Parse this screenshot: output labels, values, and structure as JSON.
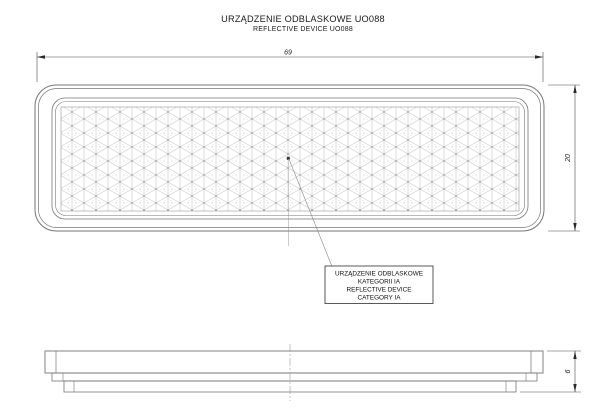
{
  "drawing": {
    "title": {
      "line1": "URZĄDZENIE ODBLASKOWE UO088",
      "line2": "REFLECTIVE DEVICE UO088"
    },
    "dimensions": {
      "width_mm": "69",
      "height_mm": "20",
      "thickness_mm": "6"
    },
    "callout": {
      "line1": "URZĄDZENIE ODBLASKOWE",
      "line2": "KATEGORII IA",
      "line3": "REFLECTIVE DEVICE",
      "line4": "CATEGORY IA"
    },
    "colors": {
      "background": "#ffffff",
      "part_outline": "#767676",
      "dimension_line": "#4a4a4a",
      "pattern_line": "#b8b8b8",
      "text": "#1a1a1a"
    }
  }
}
